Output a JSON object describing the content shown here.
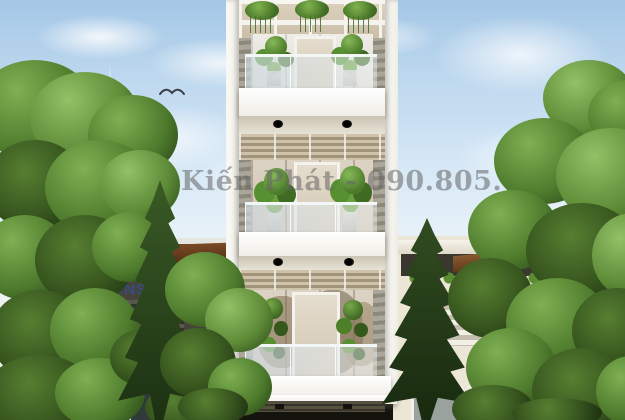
{
  "watermarks": {
    "center": {
      "text": "Phan Kiến Phát - 090.805.603 - (028) 376.717",
      "color": "#696969"
    },
    "corner": {
      "line1": "PHAN KIẾN PHÁT CORP",
      "line2": "DESIGN & CONSTRUCTION",
      "color": "#2855aa"
    }
  },
  "palette": {
    "sky_top": "#a4c7e6",
    "sky_low": "#f2f0e9",
    "foliage_light": "#93c167",
    "foliage_mid": "#7fb052",
    "foliage_dark": "#37551e",
    "conifer_dark": "#1c3112",
    "facade_white": "#f7f6f0",
    "glass_tan": "#d7cbb8",
    "glass_frost": "#e9e7e0",
    "wood_fascia": "#8a5a30",
    "ground_dark": "#15130e"
  }
}
